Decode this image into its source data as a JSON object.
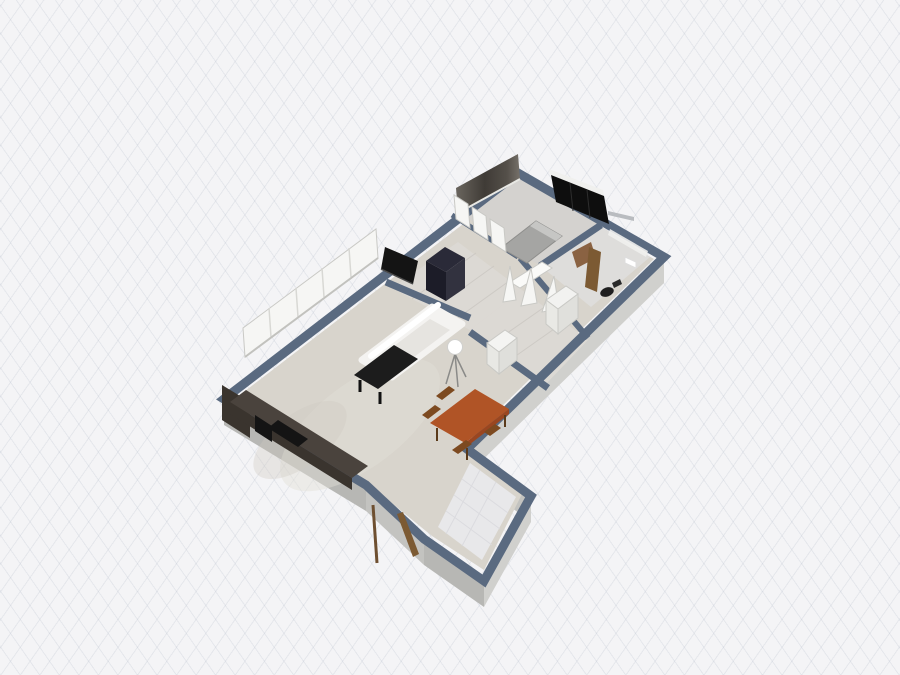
{
  "scene": {
    "view": "3d-floorplan-perspective",
    "rooms": [
      {
        "name": "living-room"
      },
      {
        "name": "hallway"
      },
      {
        "name": "bedroom"
      },
      {
        "name": "bathroom"
      },
      {
        "name": "closet"
      },
      {
        "name": "balcony"
      },
      {
        "name": "entry"
      }
    ],
    "furniture": [
      {
        "name": "window-band"
      },
      {
        "name": "tv-panel"
      },
      {
        "name": "navy-wardrobe"
      },
      {
        "name": "white-sofa"
      },
      {
        "name": "coffee-table"
      },
      {
        "name": "floor-lamp"
      },
      {
        "name": "dining-table"
      },
      {
        "name": "dining-chairs"
      },
      {
        "name": "kitchen-counter"
      },
      {
        "name": "kitchen-appliance"
      },
      {
        "name": "entry-door"
      },
      {
        "name": "double-bed"
      },
      {
        "name": "accent-wall"
      },
      {
        "name": "french-doors"
      },
      {
        "name": "open-door-fan"
      },
      {
        "name": "white-closet"
      },
      {
        "name": "white-cabinet"
      },
      {
        "name": "black-wardrobe-panel"
      },
      {
        "name": "bathroom-door"
      },
      {
        "name": "toilet"
      },
      {
        "name": "bedroom-desk"
      }
    ]
  },
  "colors": {
    "background": "#f4f4f6",
    "grid_line": "#e2e5ea",
    "wall_cap": "#5a6a80",
    "wall_face_light": "#d0d0cd",
    "wall_face_mid": "#c3c3c0",
    "wall_face_dark": "#b7b7b4",
    "floor_living": "#d8d4cc",
    "floor_hall": "#dcd9d4",
    "floor_bedroom": "#d4d2cf",
    "floor_bath": "#dedddb",
    "floor_balcony": "#e8e8ea",
    "sofa": "#f4f3f1",
    "sofa_seat": "#e6e4e0",
    "coffee_table": "#1c1c1c",
    "dining_table": "#b05426",
    "dining_table_edge": "#9a4620",
    "dining_chair": "#7d4a20",
    "tv_panel": "#141414",
    "wardrobe_navy": "#2a2a38",
    "wardrobe_navy_dark": "#1c1c28",
    "wardrobe_navy_side": "#32323f",
    "counter": "#4a433d",
    "counter_face": "#3a342e",
    "appliance": "#141414",
    "bed": "#a5a5a3",
    "bed_pillow": "#c6c6c4",
    "accent_wall_a": "#3f3b36",
    "accent_wall_b": "#6a655e",
    "door_wood": "#7c5a33",
    "white_panel": "#f6f6f4",
    "black_panel": "#0e0e0e",
    "ledge": "#b9bcc0",
    "lamp": "#ffffff",
    "desk_wood": "#8a6242",
    "toilet_dark": "#1f1f1f"
  }
}
